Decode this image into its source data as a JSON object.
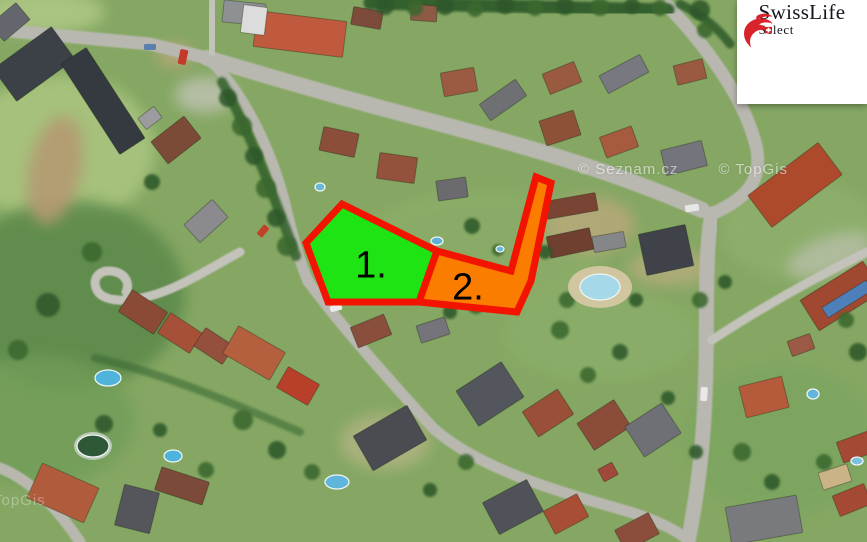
{
  "logo": {
    "brand": "SwissLife",
    "sub": "Select",
    "accent_color": "#d8232a",
    "text_color": "#15151f"
  },
  "watermarks": {
    "seznam": "© Seznam.cz",
    "topgis": "© TopGis",
    "topgis_corner": "TopGis"
  },
  "plots": {
    "border_color": "#f21400",
    "border_width": 7,
    "items": [
      {
        "label": "1.",
        "fill_color": "#1fe414",
        "points": "342,204 437,251 419,302 328,302 306,243"
      },
      {
        "label": "2.",
        "fill_color": "#fa7d00",
        "points": "437,251 511,271 536,177 551,183 531,281 517,312 419,302"
      }
    ]
  },
  "scene": {
    "base_color": "#85a763",
    "road_color": "#b9b8b0",
    "lane_color": "#c4c3bb",
    "patches": [
      [
        60,
        150,
        95,
        75,
        "#a9c47e",
        0.9,
        0
      ],
      [
        40,
        12,
        65,
        22,
        "#b2cb88",
        0.8,
        0
      ],
      [
        70,
        295,
        115,
        95,
        "#5d8a4c",
        0.9,
        0
      ],
      [
        40,
        420,
        95,
        65,
        "#6f9d58",
        0.8,
        0
      ],
      [
        480,
        250,
        125,
        60,
        "#8fb06c",
        0.55,
        0
      ],
      [
        800,
        230,
        80,
        50,
        "#95b573",
        0.5,
        0
      ],
      [
        55,
        170,
        26,
        55,
        "#b59a72",
        0.9,
        12
      ],
      [
        175,
        55,
        18,
        12,
        "#bfa57b",
        0.8,
        0
      ],
      [
        780,
        440,
        95,
        75,
        "#7aa55e",
        0.7,
        0
      ],
      [
        600,
        335,
        95,
        45,
        "#8db26d",
        0.55,
        0
      ],
      [
        590,
        225,
        45,
        28,
        "#c2a87e",
        0.7,
        0
      ],
      [
        670,
        268,
        42,
        18,
        "#c7ae85",
        0.6,
        0
      ],
      [
        385,
        442,
        45,
        28,
        "#cdbb97",
        0.5,
        0
      ],
      [
        205,
        95,
        30,
        18,
        "#c9c8c0",
        0.7,
        0
      ],
      [
        830,
        255,
        45,
        18,
        "#c6c5bd",
        0.6,
        -20
      ]
    ],
    "roads": [
      [
        "M0,30 L150,44 L207,58",
        13,
        "#b9b8b0"
      ],
      [
        "M207,58 C300,86 380,108 434,122 C500,140 600,165 702,210",
        16,
        "#b9b8b0"
      ],
      [
        "M210,56 L214,0",
        10,
        "#c4c3bb"
      ],
      [
        "M668,6 C700,40 745,95 757,150 C762,185 742,200 712,214",
        13,
        "#b9b8b0"
      ],
      [
        "M712,214 C705,250 707,300 706,360 C705,430 700,480 688,542",
        15,
        "#b9b8b0"
      ],
      [
        "M210,60 C240,90 268,140 284,200 C292,235 300,262 308,281",
        11,
        "#b9b8b0"
      ],
      [
        "M308,281 C335,318 380,370 433,428 C480,470 560,492 630,512 C655,520 672,528 686,538",
        11,
        "#b9b8b0"
      ],
      [
        "M240,252 C210,268 180,288 150,296 C120,304 100,300 96,288 C92,276 102,268 116,272 C126,275 130,284 126,292",
        9,
        "#c4c3bb"
      ],
      [
        "M0,468 C30,480 55,505 80,542",
        11,
        "#b9b8b0"
      ],
      [
        "M712,340 C750,315 800,285 867,252",
        9,
        "#c4c3bb"
      ]
    ],
    "hedges": [
      [
        "M370,3 L668,10",
        13,
        "#2f5a2b",
        0.92
      ],
      [
        "M222,82 C250,132 272,192 296,256",
        10,
        "#33602c",
        0.85
      ],
      [
        "M95,358 C160,372 230,402 300,432",
        8,
        "#3a6a34",
        0.6
      ],
      [
        "M680,4 C700,14 718,28 730,44",
        9,
        "#2f5a2b",
        0.85
      ]
    ],
    "houses": [
      [
        10,
        22,
        34,
        22,
        -40,
        "#63666c"
      ],
      [
        34,
        64,
        72,
        40,
        -36,
        "#3c4148"
      ],
      [
        103,
        101,
        108,
        30,
        57,
        "#343a40"
      ],
      [
        244,
        13,
        42,
        22,
        6,
        "#8e9194"
      ],
      [
        300,
        34,
        90,
        36,
        7,
        "#bf5a3e"
      ],
      [
        254,
        20,
        24,
        28,
        7,
        "#dddcdc"
      ],
      [
        367,
        18,
        30,
        18,
        10,
        "#7d4b3a"
      ],
      [
        424,
        13,
        26,
        16,
        4,
        "#8c5a45"
      ],
      [
        459,
        82,
        34,
        24,
        -10,
        "#9c5a42"
      ],
      [
        503,
        100,
        44,
        20,
        -35,
        "#6f7074"
      ],
      [
        562,
        78,
        34,
        22,
        -22,
        "#9a5a40"
      ],
      [
        624,
        74,
        46,
        20,
        -28,
        "#787980"
      ],
      [
        690,
        72,
        30,
        20,
        -14,
        "#9a5a42"
      ],
      [
        560,
        128,
        36,
        26,
        -18,
        "#8d5138"
      ],
      [
        619,
        142,
        34,
        22,
        -20,
        "#a65a3e"
      ],
      [
        684,
        158,
        42,
        26,
        -14,
        "#74747c"
      ],
      [
        176,
        140,
        42,
        28,
        -38,
        "#7b4b38"
      ],
      [
        206,
        221,
        38,
        24,
        -42,
        "#8b8b8f"
      ],
      [
        150,
        118,
        20,
        14,
        -38,
        "#9c9ca0"
      ],
      [
        339,
        142,
        36,
        24,
        12,
        "#8a4e3a"
      ],
      [
        397,
        168,
        38,
        26,
        8,
        "#94523c"
      ],
      [
        452,
        189,
        30,
        20,
        -8,
        "#6b6b6f"
      ],
      [
        571,
        206,
        52,
        18,
        -10,
        "#7a4434"
      ],
      [
        570,
        243,
        44,
        22,
        -12,
        "#6f3f30"
      ],
      [
        609,
        242,
        32,
        16,
        -10,
        "#85868a"
      ],
      [
        666,
        250,
        48,
        42,
        -12,
        "#3f4349"
      ],
      [
        795,
        185,
        88,
        40,
        -37,
        "#ad4a2c"
      ],
      [
        841,
        296,
        74,
        36,
        -32,
        "#a04830"
      ],
      [
        847,
        299,
        52,
        12,
        -32,
        "#4d80b8"
      ],
      [
        764,
        397,
        44,
        32,
        -14,
        "#b55a3a"
      ],
      [
        801,
        345,
        24,
        16,
        -20,
        "#9a5a45"
      ],
      [
        856,
        447,
        34,
        22,
        -20,
        "#a44a34"
      ],
      [
        835,
        477,
        30,
        18,
        -18,
        "#c9b387"
      ],
      [
        852,
        500,
        34,
        22,
        -22,
        "#a44a34"
      ],
      [
        764,
        520,
        72,
        38,
        -10,
        "#797a7e"
      ],
      [
        143,
        312,
        42,
        26,
        33,
        "#8a4a36"
      ],
      [
        180,
        333,
        38,
        24,
        33,
        "#a65038"
      ],
      [
        214,
        346,
        34,
        22,
        33,
        "#94503c"
      ],
      [
        254,
        353,
        54,
        32,
        30,
        "#b4603f"
      ],
      [
        298,
        386,
        36,
        24,
        30,
        "#b8402a"
      ],
      [
        63,
        493,
        62,
        38,
        24,
        "#b05c3c"
      ],
      [
        137,
        509,
        36,
        42,
        14,
        "#55565c"
      ],
      [
        182,
        486,
        50,
        24,
        18,
        "#7c4a38"
      ],
      [
        390,
        438,
        62,
        40,
        -30,
        "#4a4c52"
      ],
      [
        490,
        394,
        54,
        42,
        -33,
        "#54565d"
      ],
      [
        548,
        413,
        42,
        30,
        -33,
        "#9a5038"
      ],
      [
        604,
        425,
        44,
        32,
        -33,
        "#8c4c3a"
      ],
      [
        653,
        430,
        44,
        36,
        -33,
        "#6e7076"
      ],
      [
        513,
        507,
        50,
        36,
        -28,
        "#50525a"
      ],
      [
        566,
        514,
        38,
        26,
        -28,
        "#a84e34"
      ],
      [
        637,
        532,
        38,
        24,
        -28,
        "#8c4e3c"
      ],
      [
        608,
        472,
        16,
        14,
        -28,
        "#a0493a"
      ],
      [
        371,
        331,
        36,
        22,
        -22,
        "#8a4e3c"
      ],
      [
        433,
        330,
        30,
        18,
        -18,
        "#74747a"
      ]
    ],
    "trees": [
      [
        385,
        6,
        9
      ],
      [
        415,
        8,
        8
      ],
      [
        445,
        6,
        9
      ],
      [
        475,
        9,
        8
      ],
      [
        505,
        5,
        9
      ],
      [
        535,
        8,
        8
      ],
      [
        565,
        6,
        9
      ],
      [
        600,
        7,
        9
      ],
      [
        632,
        6,
        8
      ],
      [
        660,
        8,
        8
      ],
      [
        700,
        10,
        10
      ],
      [
        705,
        30,
        8
      ],
      [
        228,
        98,
        9
      ],
      [
        242,
        126,
        10
      ],
      [
        254,
        156,
        9
      ],
      [
        266,
        188,
        10
      ],
      [
        276,
        218,
        9
      ],
      [
        287,
        246,
        10
      ],
      [
        152,
        182,
        8
      ],
      [
        92,
        252,
        10
      ],
      [
        48,
        305,
        12
      ],
      [
        18,
        350,
        10
      ],
      [
        472,
        226,
        8
      ],
      [
        498,
        250,
        6
      ],
      [
        545,
        252,
        7
      ],
      [
        476,
        306,
        8
      ],
      [
        450,
        312,
        7
      ],
      [
        560,
        330,
        9
      ],
      [
        620,
        352,
        8
      ],
      [
        588,
        375,
        8
      ],
      [
        668,
        398,
        7
      ],
      [
        700,
        300,
        8
      ],
      [
        725,
        282,
        7
      ],
      [
        567,
        300,
        8
      ],
      [
        636,
        300,
        7
      ],
      [
        243,
        420,
        10
      ],
      [
        277,
        450,
        9
      ],
      [
        312,
        472,
        8
      ],
      [
        104,
        424,
        9
      ],
      [
        206,
        470,
        8
      ],
      [
        160,
        430,
        7
      ],
      [
        742,
        452,
        9
      ],
      [
        772,
        482,
        8
      ],
      [
        824,
        462,
        8
      ],
      [
        858,
        352,
        9
      ],
      [
        846,
        320,
        8
      ],
      [
        696,
        452,
        7
      ],
      [
        466,
        462,
        8
      ],
      [
        430,
        490,
        7
      ]
    ],
    "pads": [
      [
        600,
        287,
        32,
        21,
        "#d8c9a6",
        0.9
      ],
      [
        93,
        446,
        19,
        14,
        "#cdd4cb",
        0.8
      ]
    ],
    "pools": [
      [
        320,
        187,
        5,
        4,
        "#6ab7d6"
      ],
      [
        437,
        241,
        6,
        4,
        "#5fb0d4"
      ],
      [
        500,
        249,
        4,
        3,
        "#6ab7d6"
      ],
      [
        108,
        378,
        13,
        8,
        "#4fb3dc"
      ],
      [
        173,
        456,
        9,
        6,
        "#4fb3dc"
      ],
      [
        600,
        287,
        20,
        13,
        "#a6d9e8"
      ],
      [
        337,
        482,
        12,
        7,
        "#5fb6da"
      ],
      [
        813,
        394,
        6,
        5,
        "#5fb6da"
      ],
      [
        857,
        461,
        6,
        4,
        "#7bc0dd"
      ],
      [
        93,
        446,
        16,
        11,
        "#2e5838"
      ]
    ],
    "cars": [
      [
        183,
        57,
        8,
        15,
        12,
        "#c43a2a"
      ],
      [
        704,
        394,
        7,
        14,
        4,
        "#e8e8e8"
      ],
      [
        263,
        231,
        7,
        12,
        40,
        "#c04028"
      ],
      [
        150,
        47,
        12,
        6,
        0,
        "#5a7fae"
      ],
      [
        692,
        208,
        14,
        7,
        -8,
        "#e6e6e6"
      ],
      [
        336,
        308,
        12,
        6,
        -15,
        "#ececec"
      ]
    ]
  }
}
